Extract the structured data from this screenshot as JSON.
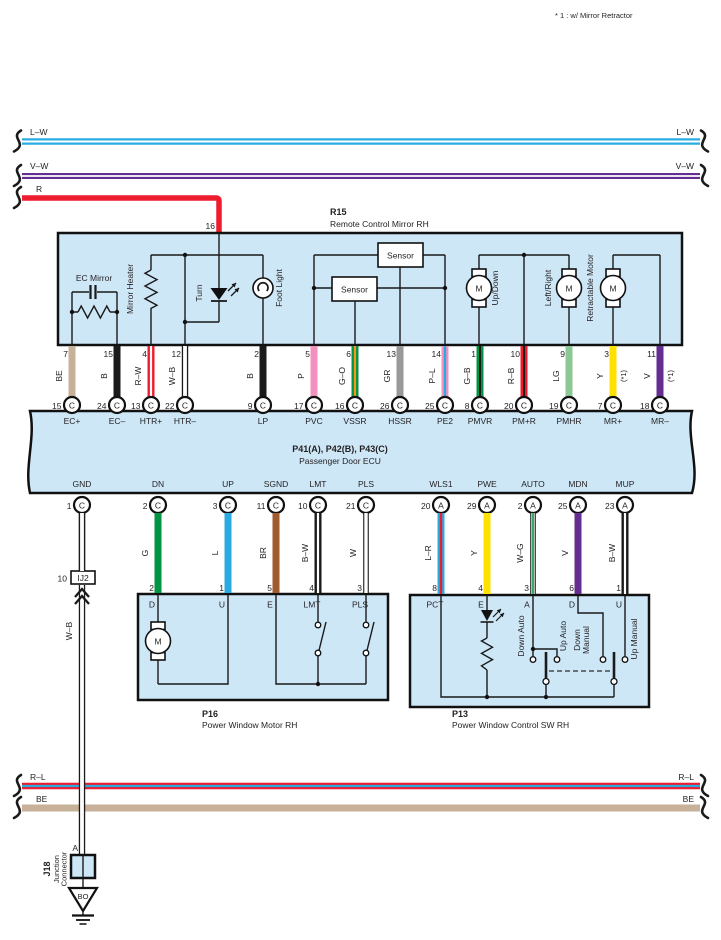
{
  "note": "* 1 : w/ Mirror Retractor",
  "buses": {
    "lw_left": "L–W",
    "lw_right": "L–W",
    "vw_left": "V–W",
    "vw_right": "V–W",
    "r_left": "R",
    "rl_left": "R–L",
    "rl_right": "R–L",
    "be_left": "BE",
    "be_right": "BE"
  },
  "r15": {
    "id": "R15",
    "title": "Remote Control Mirror RH",
    "pin16": "16",
    "components": {
      "ec_mirror": "EC Mirror",
      "mirror_heater": "Mirror Heater",
      "turn": "Turn",
      "foot_light": "Foot Light",
      "sensor_a": "Sensor",
      "sensor_b": "Sensor",
      "up_down": "Up/Down",
      "left_right": "Left/Right",
      "retractable": "Retractable Motor",
      "motor": "M"
    },
    "pins": [
      {
        "pin": "7",
        "wire": "BE",
        "conn": "15",
        "letter": "C",
        "ecu": "EC+"
      },
      {
        "pin": "15",
        "wire": "B",
        "conn": "24",
        "letter": "C",
        "ecu": "EC–"
      },
      {
        "pin": "4",
        "wire": "R–W",
        "conn": "13",
        "letter": "C",
        "ecu": "HTR+"
      },
      {
        "pin": "12",
        "wire": "W–B",
        "conn": "22",
        "letter": "C",
        "ecu": "HTR–"
      },
      {
        "pin": "2",
        "wire": "B",
        "conn": "9",
        "letter": "C",
        "ecu": "LP"
      },
      {
        "pin": "5",
        "wire": "P",
        "conn": "17",
        "letter": "C",
        "ecu": "PVC"
      },
      {
        "pin": "6",
        "wire": "G–O",
        "conn": "16",
        "letter": "C",
        "ecu": "VSSR"
      },
      {
        "pin": "13",
        "wire": "GR",
        "conn": "26",
        "letter": "C",
        "ecu": "HSSR"
      },
      {
        "pin": "14",
        "wire": "P–L",
        "conn": "25",
        "letter": "C",
        "ecu": "PE2"
      },
      {
        "pin": "1",
        "wire": "G–B",
        "conn": "8",
        "letter": "C",
        "ecu": "PMVR"
      },
      {
        "pin": "10",
        "wire": "R–B",
        "conn": "20",
        "letter": "C",
        "ecu": "PM+R"
      },
      {
        "pin": "9",
        "wire": "LG",
        "conn": "19",
        "letter": "C",
        "ecu": "PMHR"
      },
      {
        "pin": "3",
        "wire": "Y",
        "note": "(*1)",
        "conn": "7",
        "letter": "C",
        "ecu": "MR+"
      },
      {
        "pin": "11",
        "wire": "V",
        "note": "(*1)",
        "conn": "18",
        "letter": "C",
        "ecu": "MR–"
      }
    ]
  },
  "ecu": {
    "id": "P41(A), P42(B), P43(C)",
    "title": "Passenger Door ECU",
    "pins": [
      {
        "label": "GND",
        "conn": "1",
        "letter": "C",
        "wire": "W–B"
      },
      {
        "label": "DN",
        "conn": "2",
        "letter": "C",
        "wire": "G",
        "box_pin": "2",
        "box_label": "D"
      },
      {
        "label": "UP",
        "conn": "3",
        "letter": "C",
        "wire": "L",
        "box_pin": "1",
        "box_label": "U"
      },
      {
        "label": "SGND",
        "conn": "11",
        "letter": "C",
        "wire": "BR",
        "box_pin": "5",
        "box_label": "E"
      },
      {
        "label": "LMT",
        "conn": "10",
        "letter": "C",
        "wire": "B–W",
        "box_pin": "4",
        "box_label": "LMT"
      },
      {
        "label": "PLS",
        "conn": "21",
        "letter": "C",
        "wire": "W",
        "box_pin": "3",
        "box_label": "PLS"
      },
      {
        "label": "WLS1",
        "conn": "20",
        "letter": "A",
        "wire": "L–R",
        "box_pin": "8",
        "box_label": "PCT"
      },
      {
        "label": "PWE",
        "conn": "29",
        "letter": "A",
        "wire": "Y",
        "box_pin": "4",
        "box_label": "E"
      },
      {
        "label": "AUTO",
        "conn": "2",
        "letter": "A",
        "wire": "W–G",
        "box_pin": "3",
        "box_label": "A"
      },
      {
        "label": "MDN",
        "conn": "25",
        "letter": "A",
        "wire": "V",
        "box_pin": "6",
        "box_label": "D"
      },
      {
        "label": "MUP",
        "conn": "23",
        "letter": "A",
        "wire": "B–W",
        "box_pin": "1",
        "box_label": "U"
      }
    ]
  },
  "p16": {
    "id": "P16",
    "title": "Power Window Motor RH",
    "motor": "M"
  },
  "p13": {
    "id": "P13",
    "title": "Power Window Control SW RH",
    "labels": {
      "down_auto": "Down Auto",
      "up_auto": "Up Auto",
      "down_manual_line1": "Down",
      "down_manual_line2": "Manual",
      "up_manual": "Up Manual"
    }
  },
  "junction": {
    "wire_lower": "W–B",
    "ij2_num": "10",
    "ij2": "IJ2",
    "pin_a": "A",
    "j18": "J18",
    "j18_line1": "Junction",
    "j18_line2": "Connector",
    "ground_code": "BO"
  },
  "colors": {
    "red": "#ED1C2E",
    "blue": "#29ABE2",
    "green": "#009444",
    "light_green": "#8CC896",
    "yellow": "#FFE100",
    "violet": "#662D91",
    "pink": "#F490BE",
    "orange": "#F7941E",
    "gray": "#97999B",
    "brown": "#A05A2B",
    "beige": "#C7B299",
    "black": "#1A1A1A",
    "white": "#FFFFFF",
    "box_fill": "#CDE7F7"
  }
}
